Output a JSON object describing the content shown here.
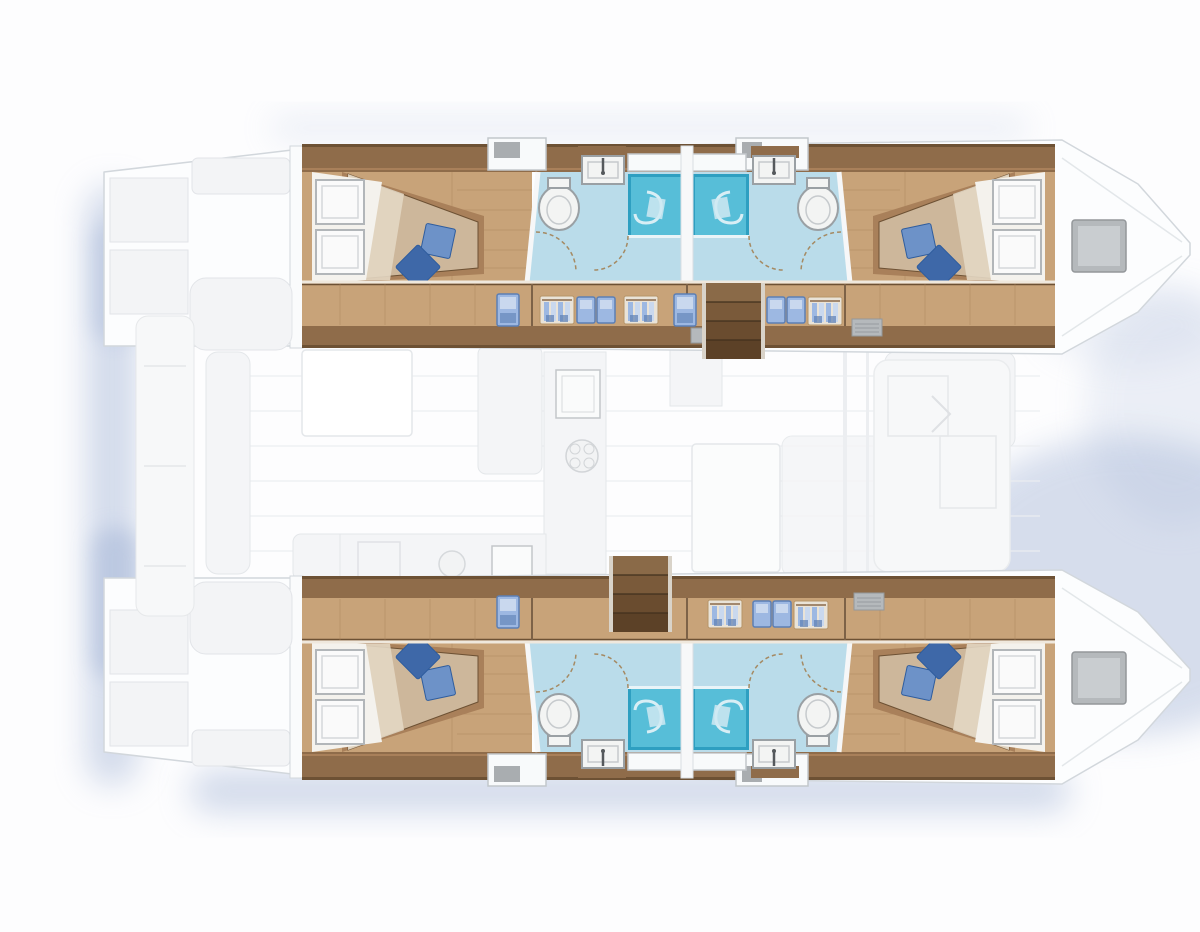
{
  "figure": {
    "kind": "yacht-floor-plan",
    "view": "top-down accommodation plan",
    "vessel": "sailing catamaran, twin hulls, bows to the right",
    "description": "Top-down layout plan of a four-cabin sailing catamaran: each hull holds two double cabins with blue cushions, two bathrooms with shower cubicles and toilets, a wardrobe corridor and companionway stairs; the central bridge-deck shows a faint saloon with galley, cockpit table, dinette and forward lounge.",
    "counts": {
      "hulls": 2,
      "cabins": 4,
      "double_berths": 4,
      "bathrooms": 4,
      "shower_cubicles": 4,
      "toilets": 4,
      "wash_basins": 4,
      "companionway_stairs": 2,
      "bow_deck_hatches": 2
    }
  },
  "rooms": [
    {
      "name": "port-aft-cabin",
      "features": [
        "double-berth",
        "blue-cushions",
        "hull-windows"
      ]
    },
    {
      "name": "port-aft-bathroom",
      "features": [
        "toilet",
        "basin",
        "shower-cubicle"
      ]
    },
    {
      "name": "port-forward-bathroom",
      "features": [
        "toilet",
        "basin",
        "shower-cubicle"
      ]
    },
    {
      "name": "port-forward-cabin",
      "features": [
        "double-berth",
        "blue-cushions",
        "hull-windows"
      ]
    },
    {
      "name": "port-corridor",
      "features": [
        "wardrobes",
        "lockers",
        "companionway-stairs"
      ]
    },
    {
      "name": "starboard-aft-cabin",
      "features": [
        "double-berth",
        "blue-cushions",
        "hull-windows"
      ]
    },
    {
      "name": "starboard-aft-bathroom",
      "features": [
        "toilet",
        "basin",
        "shower-cubicle"
      ]
    },
    {
      "name": "starboard-forward-bathroom",
      "features": [
        "toilet",
        "basin",
        "shower-cubicle"
      ]
    },
    {
      "name": "starboard-forward-cabin",
      "features": [
        "double-berth",
        "blue-cushions",
        "hull-windows"
      ]
    },
    {
      "name": "starboard-corridor",
      "features": [
        "wardrobes",
        "lockers",
        "companionway-stairs"
      ]
    },
    {
      "name": "saloon",
      "features": [
        "galley-sink",
        "galley-stove",
        "cockpit-table",
        "dinette",
        "forward-lounge"
      ]
    },
    {
      "name": "foredeck",
      "features": [
        "bow-hatches"
      ]
    },
    {
      "name": "aft-platform",
      "features": [
        "transom-steps"
      ]
    }
  ],
  "palette": {
    "page_bg": "#fdfdfe",
    "shadow_blue": "#a7b8d8",
    "hull_fill": "#fcfdfe",
    "hull_stroke": "#d2d7dc",
    "deck_panel": "#f3f4f6",
    "deck_panel_stroke": "#e2e4e8",
    "wood_dark": "#8f6c4a",
    "wood_dark_edge": "#6d5134",
    "wood_mid": "#a9805a",
    "wood_floor": "#c8a379",
    "wood_plank_line": "#ab835c",
    "wood_light_wall": "#efe8dd",
    "stairs_1": "#8a6a48",
    "stairs_2": "#7a5a3a",
    "stairs_3": "#6a4c2f",
    "stairs_4": "#5c4127",
    "stairs_rail": "#d9d3c9",
    "stairs_sep": "#42301d",
    "mattress": "#cdb79b",
    "mattress_light": "#e3d7c3",
    "sheet": "#f4f2ed",
    "panel_white": "#fafafa",
    "panel_stroke": "#b2b6b9",
    "cushion_light": "#6d92c8",
    "cushion_dark": "#3e68a8",
    "cushion_edge": "#2f5d9e",
    "bath_floor": "#badcea",
    "shower_fill": "#57bed8",
    "shower_edge": "#2e9fc1",
    "shower_glass": "#e9f4f8",
    "shower_swirl": "#d8eef5",
    "fixture": "#f3f4f3",
    "fixture_stroke": "#9aa0a4",
    "fixture_inner": "#c6cacd",
    "arc_line": "#a58a63",
    "hatch_fill": "#b5b9bc",
    "hatch_stroke": "#93979a",
    "hatch_inner": "#c9cdd0",
    "icon_blue": "#9db8e2",
    "icon_blue_dark": "#5c7fb4",
    "icon_blue_light": "#c9d8ee",
    "icon_bg": "#e9e3d8",
    "icon_frame": "#b69468",
    "saloon_fill": "#f4f5f7",
    "saloon_stroke": "#e4e7ea",
    "saloon_line": "#eceef1",
    "window_white": "#f8fafb",
    "window_stroke": "#c2c7cb"
  }
}
